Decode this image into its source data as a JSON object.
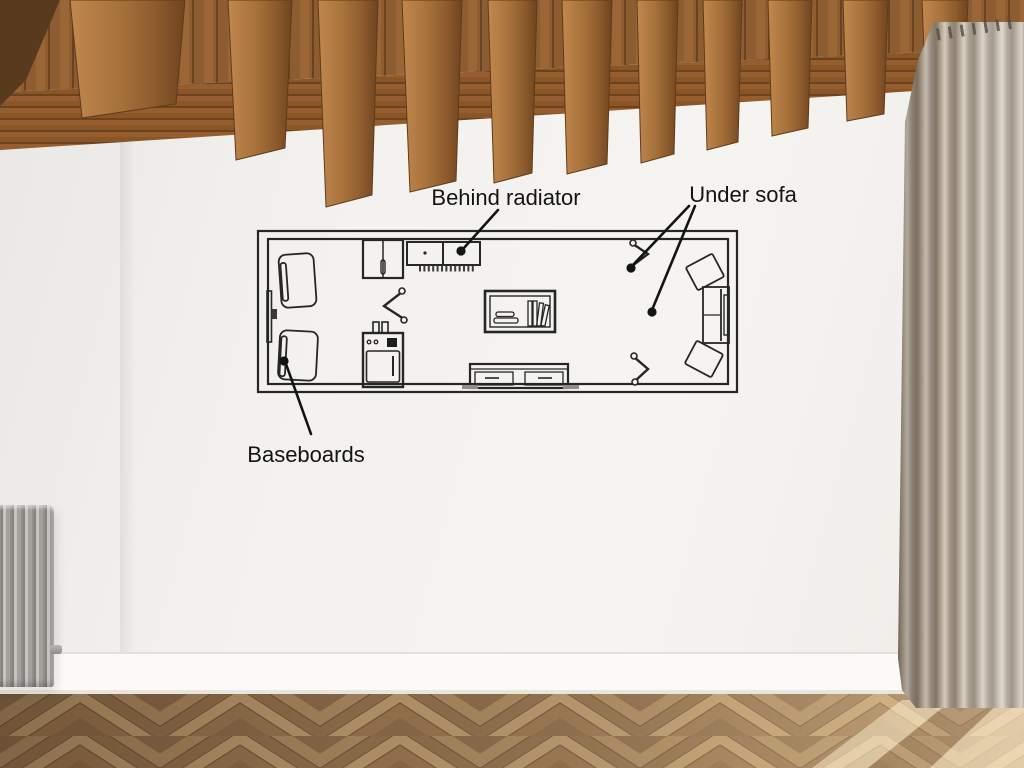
{
  "scene": {
    "description": "Empty room photo: wood beam ceiling, grey column radiator, taupe curtain, herringbone parquet floor, floor-plan sketch drawn on white wall",
    "colors": {
      "wall": "#f3f1ee",
      "ink": "#262626",
      "beam_wood_light": "#c1884e",
      "beam_wood_dark": "#6f441f",
      "plank_wood": "#8d5c31",
      "curtain": "#a89a8b",
      "radiator": "#a3a19d",
      "floor_mid": "#a0805c",
      "floor_dark": "#83644a",
      "floor_light": "#c3a379"
    }
  },
  "plan": {
    "marker_count": 4,
    "items": [
      "armchair-top-left",
      "armchair-bottom-left",
      "wall-door-panel",
      "wall-outlet",
      "cabinet",
      "radiator-top",
      "corner-bracket-left",
      "appliance-stove",
      "bookshelf",
      "tv-stand",
      "corner-bracket-top-right",
      "corner-bracket-bottom-right",
      "sectional-sofa-right"
    ]
  },
  "annotations": {
    "behind_radiator": {
      "label": "Behind radiator"
    },
    "under_sofa": {
      "label": "Under sofa",
      "marker_count": 2
    },
    "baseboards": {
      "label": "Baseboards"
    }
  }
}
